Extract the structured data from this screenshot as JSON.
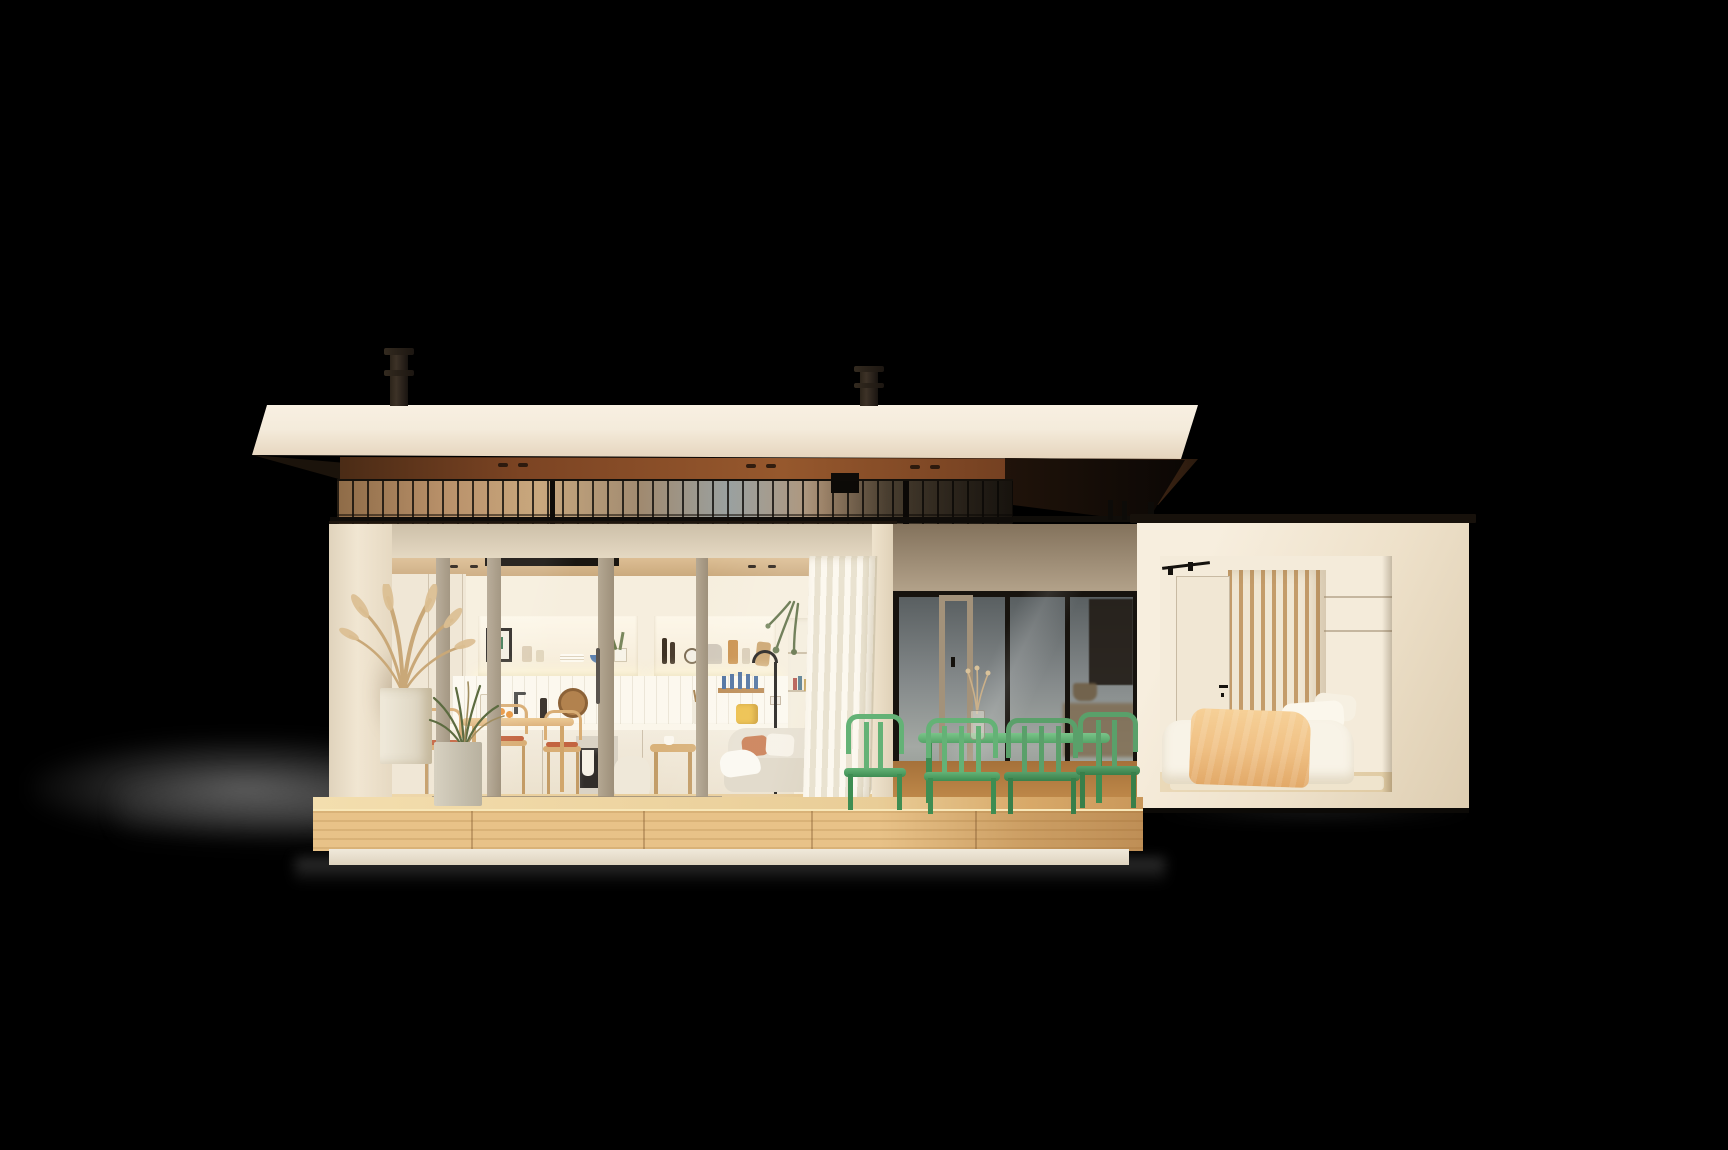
{
  "scene": {
    "title": "Modern prefab house — evening exterior render",
    "description": "Cutaway-style render of a flat-roof modular house on a black background: an open kitchen and living room glow behind a sliding glass wall, a covered terrace holds a green metal dining set, and a separate bedroom module with a wood-slat wall sits to the right, all raised on a light wooden deck.",
    "canvas": {
      "width": 1728,
      "height": 1150
    }
  },
  "palette": {
    "bg": "#000000",
    "roofCream": "#f4ebdb",
    "roofCreamShade": "#e5d4bc",
    "soffitWood": "#7c4423",
    "clerestoryCool": "#9aa1a0",
    "interiorWarm": "#f6eedd",
    "counterWhite": "#fbf6ea",
    "deckWood": "#e8c288",
    "terraceGlassTop": "#565c5e",
    "terraceGlassBottom": "#a4a9a4",
    "terraceWallShade": "#b3a28a",
    "green": "#64b276",
    "greenDark": "#3e8d52",
    "curtainWhite": "#faf5ea",
    "curtainBeige": "#d8c6a8",
    "slatWood": "#c49c6a",
    "bedThrow": "#f0c185",
    "sofaBeige": "#e6dfd0",
    "woodChair": "#d8ac72",
    "terracotta": "#c2613c",
    "ovenDark": "#2e2a26",
    "artDark": "#221c16",
    "terraceFloor": "#c8914f",
    "accentYellow": "#ecbd43",
    "knifeBlue": "#4a6e9e"
  },
  "house": {
    "roof": {
      "label": "flat roof with mahogany soffit and two flue chimneys",
      "chimneys": 2
    },
    "clerestory": {
      "label": "clerestory glazing band"
    },
    "living_module": {
      "label": "kitchen and living module",
      "shelf_items": "framed print, glassware, stacked plates, blue bowl, potted plant, oil bottles, wall clock, pitcher, storage jars, cutting board",
      "counter_items": "cutting boards, faucet, magnetic knife strip, utensil crock, yellow toaster, built-in oven",
      "furniture": "wooden dining chairs with terracotta seats, dining table, beige sofa, black floor lamp, side table, pouf"
    },
    "terrace": {
      "label": "covered terrace with green metal dining set",
      "chairs_visible": 4,
      "table": "green metal dining table",
      "decor": "glass vase with dried flowers"
    },
    "bedroom_module": {
      "label": "bedroom module",
      "features": "wood slat wall, interior door, track light, bed with peach throw, beige curtain"
    },
    "deck": {
      "label": "raised wooden deck platform"
    },
    "planters": {
      "label": "white planter with pampas grass and gray planter with grasses"
    }
  }
}
